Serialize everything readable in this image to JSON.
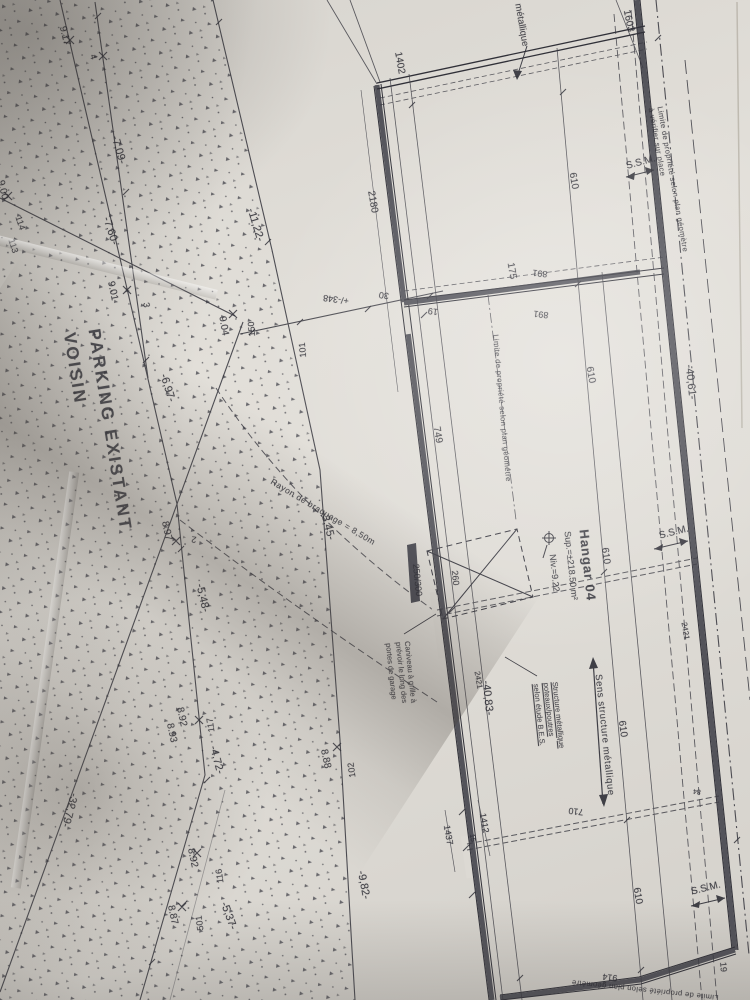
{
  "photo": {
    "paper_color": "#dcd9d3",
    "ink_color": "#2c2c34",
    "wall_color": "#53535a"
  },
  "plan": {
    "region": {
      "parking_line1": "PARKING EXISTANT",
      "parking_line2": "VOISIN"
    },
    "hangar": {
      "title": "Hangar 04",
      "surface": "Sup.=±218.50 m²",
      "level": "Niv.=9.22"
    },
    "notes": {
      "property_right_line1": "Limite de propriété selon plan géomètre",
      "property_right_line2": "à vérifier sur place",
      "property_mid": "Limite de propriété selon plan géométre",
      "property_bottom": "Limite de propriété selon plan géomètre",
      "cladding": "métallique",
      "structure_line1": "Structure métallique",
      "structure_line2": "poteaux/poutres",
      "structure_line3": "selon étude B.E.S.",
      "direction": "Sens structure métallique",
      "gutter_line1": "Caniveau à grille à",
      "gutter_line2": "prévoir le long des",
      "gutter_line3": "portes de garage",
      "turning_radius": "Rayon de braquage = 8,50m"
    },
    "labels": [
      {
        "t": "1402",
        "x": 399,
        "y": 63,
        "r": 80
      },
      {
        "t": "1603",
        "x": 628,
        "y": 21,
        "r": 78
      },
      {
        "t": "2180",
        "x": 372,
        "y": 202,
        "r": 80
      },
      {
        "t": "610",
        "x": 573,
        "y": 181,
        "r": 80
      },
      {
        "t": "175",
        "x": 511,
        "y": 271,
        "r": 80
      },
      {
        "t": "891",
        "x": 540,
        "y": 273,
        "r": 187,
        "s": 9
      },
      {
        "t": "891",
        "x": 541,
        "y": 314,
        "r": 187,
        "s": 9
      },
      {
        "t": "19",
        "x": 433,
        "y": 311,
        "r": 187,
        "s": 9
      },
      {
        "t": "30",
        "x": 384,
        "y": 295,
        "r": 187,
        "s": 9
      },
      {
        "t": "+/-348",
        "x": 336,
        "y": 299,
        "r": 187,
        "s": 9
      },
      {
        "t": "101",
        "x": 303,
        "y": 350,
        "r": 265,
        "s": 9
      },
      {
        "t": "150",
        "x": 252,
        "y": 329,
        "r": 265,
        "s": 9
      },
      {
        "t": "749",
        "x": 437,
        "y": 435,
        "r": 80
      },
      {
        "t": "610",
        "x": 590,
        "y": 375,
        "r": 80
      },
      {
        "t": "-40,61-",
        "x": 690,
        "y": 382,
        "r": 84,
        "s": 11
      },
      {
        "t": "S.S.M.",
        "x": 641,
        "y": 163,
        "r": -15,
        "n": "ssm-label"
      },
      {
        "t": "S.S.M.",
        "x": 674,
        "y": 533,
        "r": -14,
        "n": "ssm-label"
      },
      {
        "t": "S.S.M.",
        "x": 706,
        "y": 889,
        "r": -14,
        "n": "ssm-label"
      },
      {
        "t": "9.17",
        "x": 64,
        "y": 36,
        "r": 76
      },
      {
        "t": "4",
        "x": 93,
        "y": 57,
        "r": 76,
        "s": 9
      },
      {
        "t": "-7,09-",
        "x": 118,
        "y": 150,
        "r": 74,
        "s": 11
      },
      {
        "t": "-7,60-",
        "x": 110,
        "y": 231,
        "r": 72,
        "s": 11
      },
      {
        "t": "114",
        "x": 20,
        "y": 223,
        "r": 72,
        "s": 9
      },
      {
        "t": "113",
        "x": 13,
        "y": 246,
        "r": 72,
        "s": 9
      },
      {
        "t": "9.00",
        "x": 2,
        "y": 190,
        "r": 76
      },
      {
        "t": "-11,22-",
        "x": 255,
        "y": 225,
        "r": 73,
        "s": 11
      },
      {
        "t": "9.01",
        "x": 112,
        "y": 291,
        "r": 78
      },
      {
        "t": "3",
        "x": 146,
        "y": 305,
        "r": 80,
        "s": 9
      },
      {
        "t": "9.04",
        "x": 223,
        "y": 326,
        "r": 80
      },
      {
        "t": "-6,97-",
        "x": 167,
        "y": 388,
        "r": 73,
        "s": 11
      },
      {
        "t": "-3,45-",
        "x": 327,
        "y": 526,
        "r": 75,
        "s": 11
      },
      {
        "t": "8.97",
        "x": 166,
        "y": 531,
        "r": 78
      },
      {
        "t": "2",
        "x": 194,
        "y": 539,
        "r": 187,
        "s": 9
      },
      {
        "t": "-5,48-",
        "x": 202,
        "y": 598,
        "r": 77,
        "s": 11
      },
      {
        "t": "8.92",
        "x": 181,
        "y": 717,
        "r": 78
      },
      {
        "t": "8.93",
        "x": 171,
        "y": 733,
        "r": 78
      },
      {
        "t": "117",
        "x": 211,
        "y": 725,
        "r": 262,
        "s": 9
      },
      {
        "t": "-4,72-",
        "x": 216,
        "y": 760,
        "r": 75,
        "s": 11
      },
      {
        "t": "8.88",
        "x": 325,
        "y": 759,
        "r": 78
      },
      {
        "t": "102",
        "x": 352,
        "y": 770,
        "r": 262,
        "s": 9
      },
      {
        "t": "-9,82-",
        "x": 363,
        "y": 885,
        "r": 79,
        "s": 11
      },
      {
        "t": "8.92",
        "x": 192,
        "y": 858,
        "r": 78
      },
      {
        "t": "116",
        "x": 220,
        "y": 876,
        "r": 262,
        "s": 9
      },
      {
        "t": "-5,37-",
        "x": 228,
        "y": 916,
        "r": 70,
        "s": 11
      },
      {
        "t": "501",
        "x": 200,
        "y": 923,
        "r": 262,
        "s": 9
      },
      {
        "t": "8.87",
        "x": 172,
        "y": 915,
        "r": 78
      },
      {
        "t": "-32,79-",
        "x": 69,
        "y": 810,
        "r": 105,
        "s": 11
      },
      {
        "t": "610",
        "x": 605,
        "y": 556,
        "r": 82
      },
      {
        "t": "2421",
        "x": 685,
        "y": 631,
        "r": 80,
        "s": 8
      },
      {
        "t": "2421",
        "x": 478,
        "y": 680,
        "r": 80,
        "s": 8
      },
      {
        "t": "-40,83-",
        "x": 487,
        "y": 698,
        "r": 84,
        "s": 11
      },
      {
        "t": "610",
        "x": 622,
        "y": 729,
        "r": 82
      },
      {
        "t": "710",
        "x": 576,
        "y": 811,
        "r": 187,
        "s": 9
      },
      {
        "t": "84",
        "x": 697,
        "y": 791,
        "r": 187,
        "s": 7
      },
      {
        "t": "250/300",
        "x": 417,
        "y": 580,
        "r": 84,
        "s": 9
      },
      {
        "t": "260",
        "x": 455,
        "y": 578,
        "r": 84,
        "s": 9
      },
      {
        "t": "1437",
        "x": 448,
        "y": 835,
        "r": 80,
        "s": 9
      },
      {
        "t": "15",
        "x": 472,
        "y": 838,
        "r": 80,
        "s": 7
      },
      {
        "t": "1412",
        "x": 484,
        "y": 823,
        "r": 80,
        "s": 9
      },
      {
        "t": "610",
        "x": 637,
        "y": 896,
        "r": 80
      },
      {
        "t": "914",
        "x": 610,
        "y": 977,
        "r": 187,
        "s": 9
      },
      {
        "t": "19",
        "x": 723,
        "y": 967,
        "r": 85,
        "s": 9
      }
    ]
  }
}
